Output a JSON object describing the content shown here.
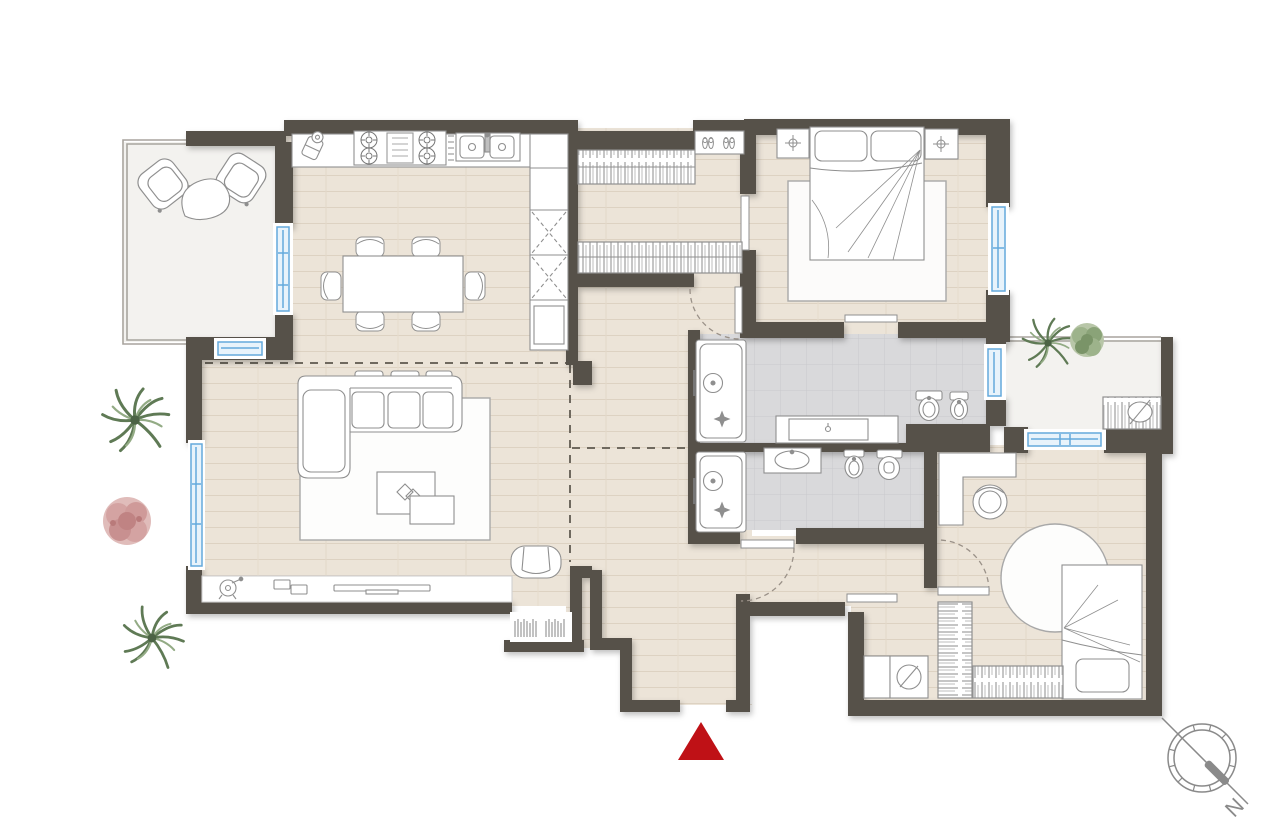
{
  "meta": {
    "kind": "apartment-floor-plan",
    "orientation_marker": "N"
  },
  "compass": {
    "north_label": "N"
  },
  "colors": {
    "page_bg": "#ffffff",
    "wall": "#57514a",
    "floor_wood": "#ece4d8",
    "floor_wood_line": "#ddd2c2",
    "floor_tile": "#d9d9db",
    "floor_balcony": "#f3f2ef",
    "window_frame": "#64a9dc",
    "window_glass": "#e8f3fb",
    "furniture_stroke": "#8f8f8f",
    "furniture_fill": "#ffffff",
    "railing": "#a8a49d",
    "zone_dash": "#6f695f",
    "door_arc": "#9a9188",
    "entrance_arrow": "#bf1116",
    "compass_stroke": "#8a8a8a",
    "plant_green": "#87a074",
    "plant_green_dark": "#5f7a55",
    "plant_pink": "#d8a7a6"
  }
}
